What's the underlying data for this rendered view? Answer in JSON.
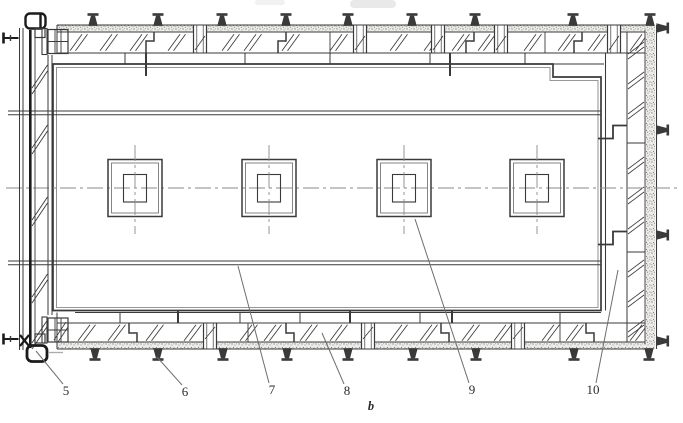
{
  "figure": {
    "type": "technical-plan-drawing",
    "caption": "b",
    "callouts": [
      {
        "label": "5",
        "x": 66,
        "y": 395,
        "tip_x": 36,
        "tip_y": 351
      },
      {
        "label": "6",
        "x": 185,
        "y": 396,
        "tip_x": 157,
        "tip_y": 357
      },
      {
        "label": "7",
        "x": 272,
        "y": 394,
        "tip_x": 238,
        "tip_y": 266
      },
      {
        "label": "8",
        "x": 347,
        "y": 395,
        "tip_x": 322,
        "tip_y": 333
      },
      {
        "label": "9",
        "x": 472,
        "y": 394,
        "tip_x": 415,
        "tip_y": 219
      },
      {
        "label": "10",
        "x": 593,
        "y": 394,
        "tip_x": 618,
        "tip_y": 270
      }
    ],
    "column_centers": [
      135,
      269,
      404,
      537
    ],
    "jacks_top_x": [
      93,
      158,
      222,
      286,
      348,
      412,
      475,
      573,
      650
    ],
    "jacks_bottom_x": [
      95,
      158,
      223,
      287,
      348,
      413,
      476,
      574,
      649
    ],
    "jacks_right_y": [
      28,
      130,
      235,
      341
    ],
    "screws_left_y": [
      38,
      339
    ],
    "colors": {
      "paper": "#ffffff",
      "ink": "#3a3a3a",
      "ink_dark": "#1b1b1b",
      "ink_light": "#777777",
      "centerline": "#8a8a8a",
      "leader": "#6e6e6e",
      "stipple_bg": "#eeece9",
      "stipple_dot": "#8a8a8a"
    }
  }
}
